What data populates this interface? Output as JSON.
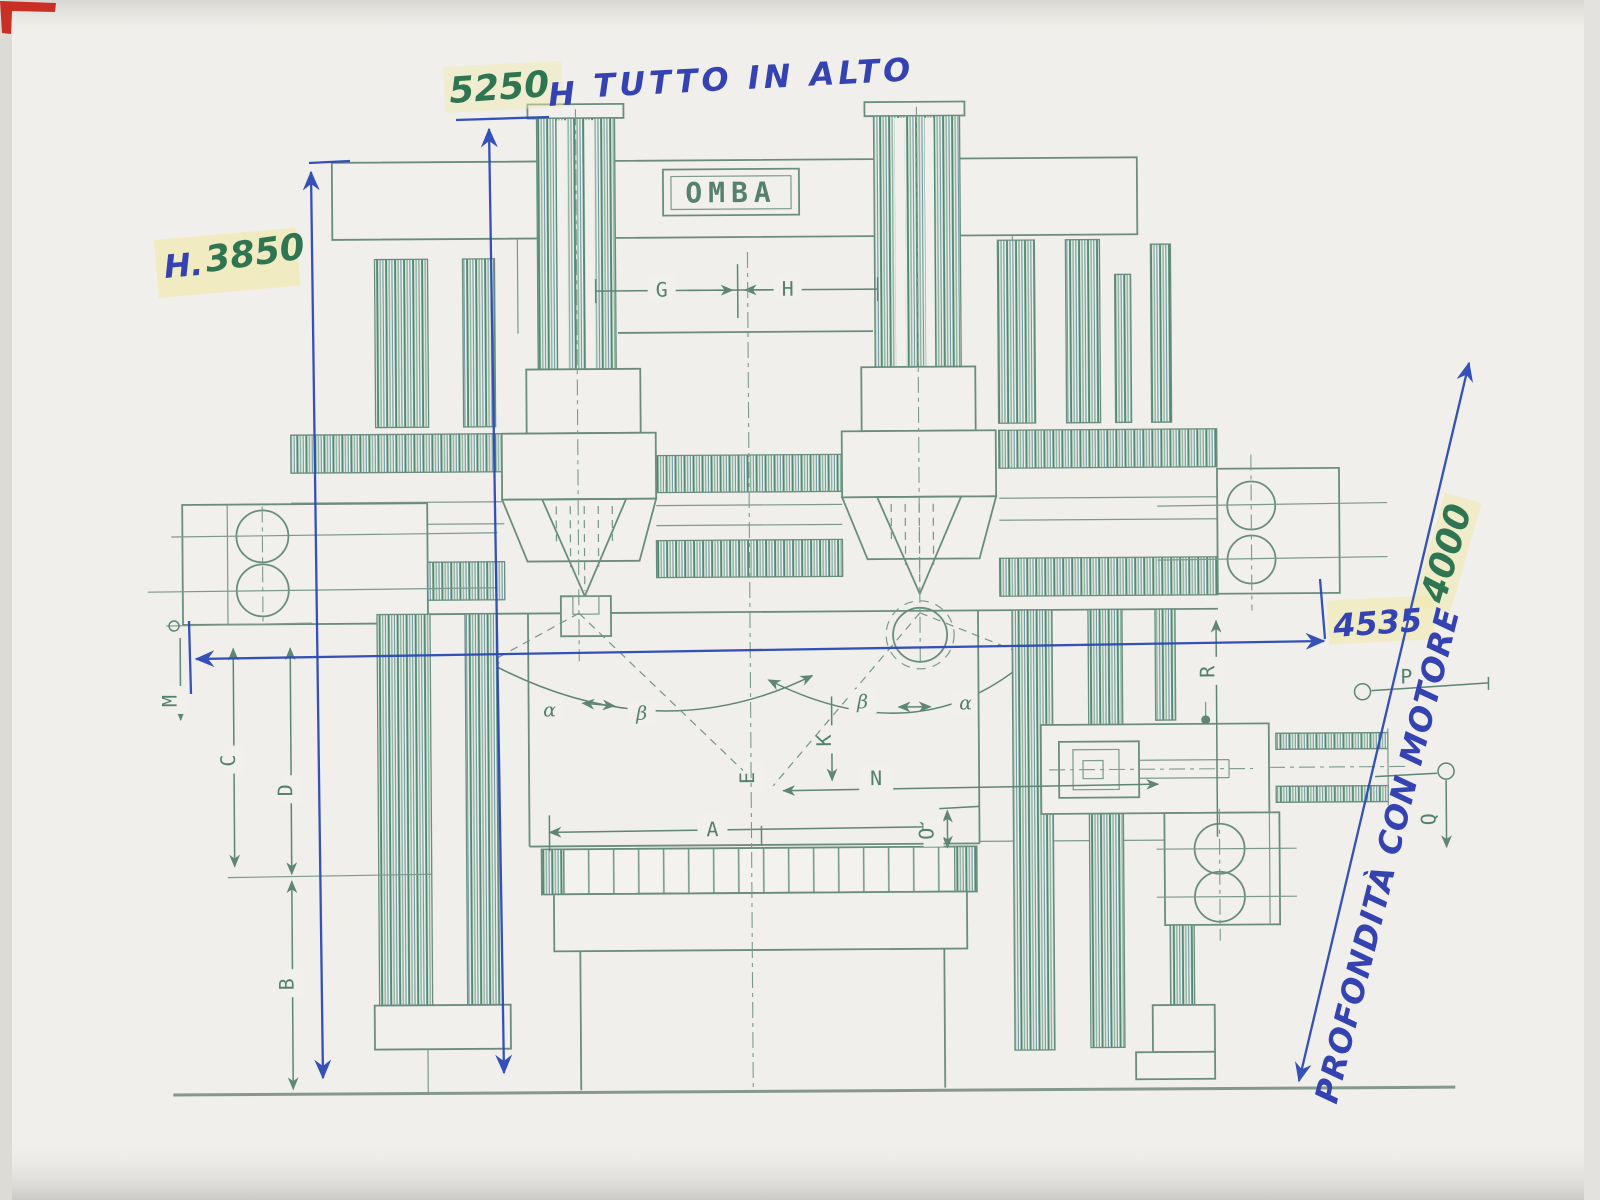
{
  "drawing": {
    "brand": "OMBA",
    "type_note": "front view technical drawing of double-column vertical lathe with handwritten dimension annotations"
  },
  "handwriting": {
    "total_height_value": "5250",
    "total_height_unit": "H",
    "top_note": "TUTTO IN ALTO",
    "machine_height_prefix": "H.",
    "machine_height_value": "3850",
    "overall_width_value": "4535",
    "depth_value": "4000",
    "depth_note": "PROFONDITÀ CON MOTORE"
  },
  "dims": {
    "g": "G",
    "h": "H",
    "m": "M",
    "c": "C",
    "d": "D",
    "b": "B",
    "a": "A",
    "n": "N",
    "o": "O",
    "k": "K",
    "e": "E",
    "r": "R",
    "p": "P",
    "q": "Q",
    "alpha": "α",
    "beta": "β"
  },
  "colors": {
    "pen_blue": "#2b49b6",
    "pen_green": "#2f7552",
    "ink_green": "#5f8577",
    "highlight_yellow": "#f0e9ae",
    "corner_mark_red": "#c92f25",
    "paper": "#f1f0ec"
  }
}
